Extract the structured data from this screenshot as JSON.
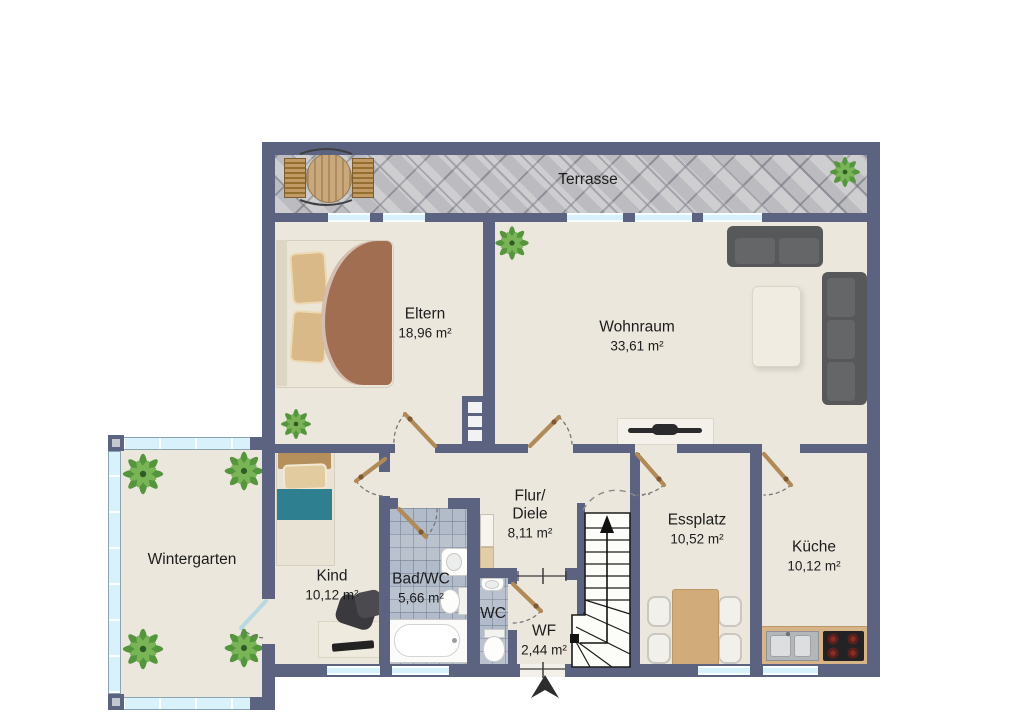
{
  "rooms": {
    "terrasse": {
      "name": "Terrasse"
    },
    "eltern": {
      "name": "Eltern",
      "area": "18,96 m²"
    },
    "wohnraum": {
      "name": "Wohnraum",
      "area": "33,61 m²"
    },
    "wintergarten": {
      "name": "Wintergarten"
    },
    "kind": {
      "name": "Kind",
      "area": "10,12 m²"
    },
    "bad": {
      "name": "Bad/WC",
      "area": "5,66 m²"
    },
    "flur": {
      "name_line1": "Flur/",
      "name_line2": "Diele",
      "area": "8,11 m²"
    },
    "wc": {
      "name": "WC"
    },
    "wf": {
      "name": "WF",
      "area": "2,44 m²"
    },
    "essplatz": {
      "name": "Essplatz",
      "area": "10,52 m²"
    },
    "kueche": {
      "name": "Küche",
      "area": "10,12 m²"
    }
  },
  "colors": {
    "wall": "#5b6380",
    "floor": "#ebe7dc",
    "window_glass": "#d6f1fb",
    "bath_tile": "#b2bbc9",
    "door_leaf_wood": "#b28a58",
    "sofa_gray": "#57585a",
    "bed_blanket_brown": "#a26e52",
    "kid_blanket_teal": "#2e7f90",
    "dining_wood": "#d2ab7a",
    "plant_green": "#55953d"
  }
}
